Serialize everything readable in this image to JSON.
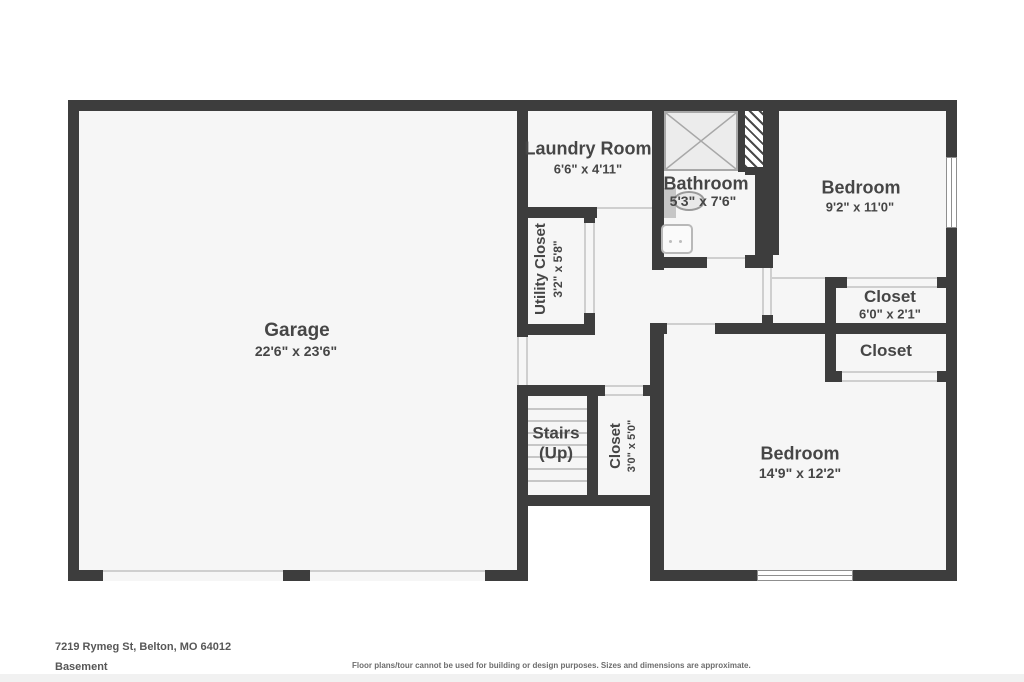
{
  "floorplan": {
    "address": "7219 Rymeg St, Belton, MO 64012",
    "level": "Basement",
    "disclaimer": "Floor plans/tour cannot be used for building or design purposes. Sizes and dimensions are approximate.",
    "colors": {
      "wall": "#3d3d3d",
      "floor": "#f6f6f6",
      "label_text": "#464646",
      "opening_line": "#cfcfcf",
      "fixture_fill": "#ececec"
    },
    "rooms": {
      "garage": {
        "name": "Garage",
        "dims": "22'6\" x 23'6\""
      },
      "laundry": {
        "name": "Laundry Room",
        "dims": "6'6\" x 4'11\""
      },
      "bathroom": {
        "name": "Bathroom",
        "dims": "5'3\" x 7'6\""
      },
      "bedroom_upper": {
        "name": "Bedroom",
        "dims": "9'2\" x 11'0\""
      },
      "utility_closet": {
        "name": "Utility Closet",
        "dims": "3'2\" x 5'8\""
      },
      "closet_upper": {
        "name": "Closet",
        "dims": "6'0\" x 2'1\""
      },
      "closet_lower": {
        "name": "Closet"
      },
      "stairs": {
        "line1": "Stairs",
        "line2": "(Up)"
      },
      "closet_hall": {
        "name": "Closet",
        "dims": "3'0\" x 5'0\""
      },
      "bedroom_lower": {
        "name": "Bedroom",
        "dims": "14'9\" x 12'2\""
      }
    }
  }
}
